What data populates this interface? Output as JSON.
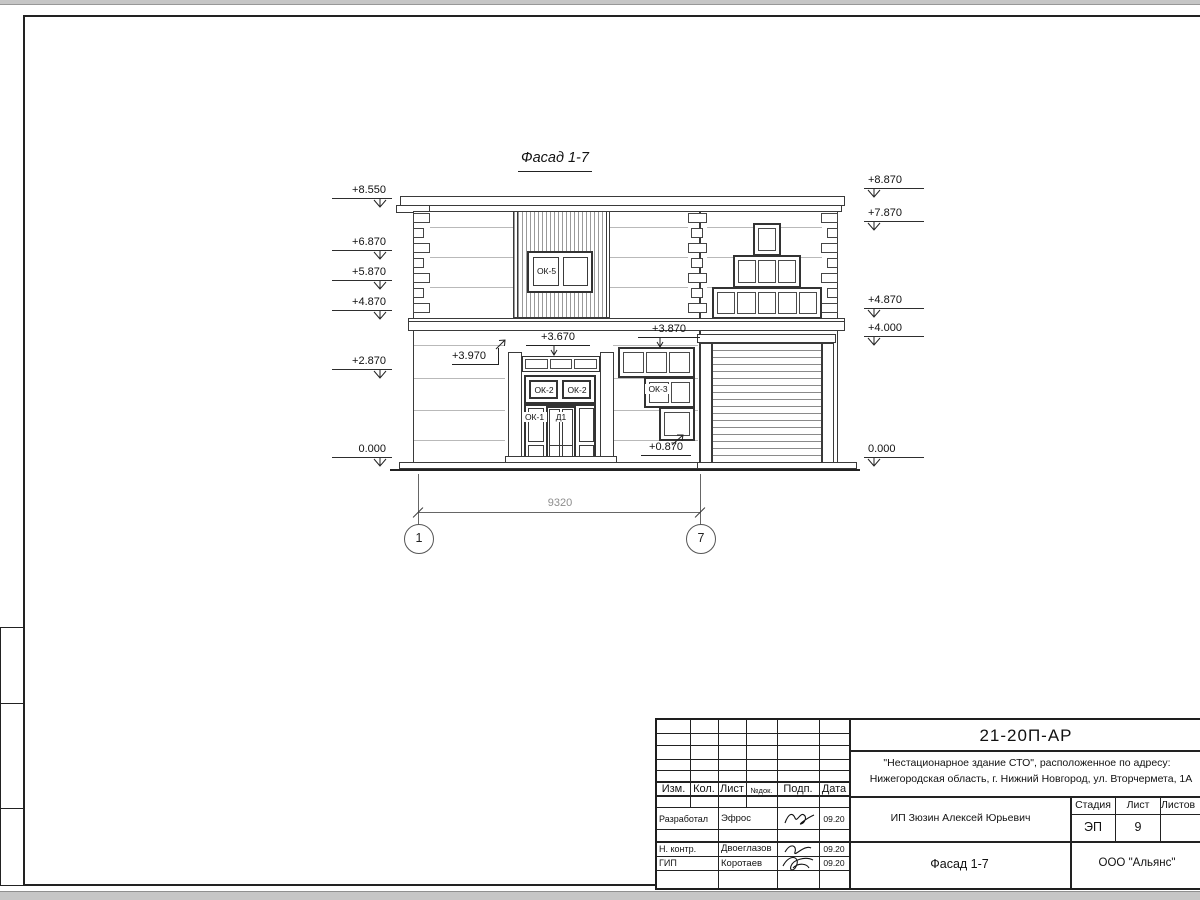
{
  "facade": {
    "view_title": "Фасад 1-7",
    "windows": {
      "ok5": "ОК-5",
      "ok2": "ОК-2",
      "ok1": "ОК-1",
      "d1": "Д1",
      "ok3": "ОК-3"
    },
    "elevations_left": [
      "+8.550",
      "+6.870",
      "+5.870",
      "+4.870",
      "+2.870",
      "0.000"
    ],
    "elevations_right": [
      "+8.870",
      "+7.870",
      "+4.870",
      "+4.000",
      "0.000"
    ],
    "annotations": {
      "portal_top": "+3.970",
      "transom_top": "+3.670",
      "ok3_top": "+3.870",
      "ok3_bottom": "+0.870"
    },
    "dimension": {
      "value": "9320"
    },
    "axes": {
      "left": "1",
      "right": "7"
    }
  },
  "title_block": {
    "doc_number": "21-20П-АР",
    "project_line1": "\"Нестационарное здание СТО\", расположенное по адресу:",
    "project_line2": "Нижегородская область, г. Нижний Новгород, ул. Вторчермета, 1А",
    "client": "ИП Зюзин Алексей Юрьевич",
    "sheet_title": "Фасад 1-7",
    "company": "ООО \"Альянс\"",
    "stage_label": "Стадия",
    "sheet_label": "Лист",
    "sheets_label": "Листов",
    "stage_value": "ЭП",
    "sheet_value": "9",
    "header_cols": [
      "Изм.",
      "Кол.",
      "Лист",
      "№док.",
      "Подп.",
      "Дата"
    ],
    "rows": [
      {
        "role": "Разработал",
        "name": "Эфрос",
        "date": "09.20"
      },
      {
        "role": "Н. контр.",
        "name": "Двоеглазов",
        "date": "09.20"
      },
      {
        "role": "ГИП",
        "name": "Коротаев",
        "date": "09.20"
      }
    ]
  }
}
